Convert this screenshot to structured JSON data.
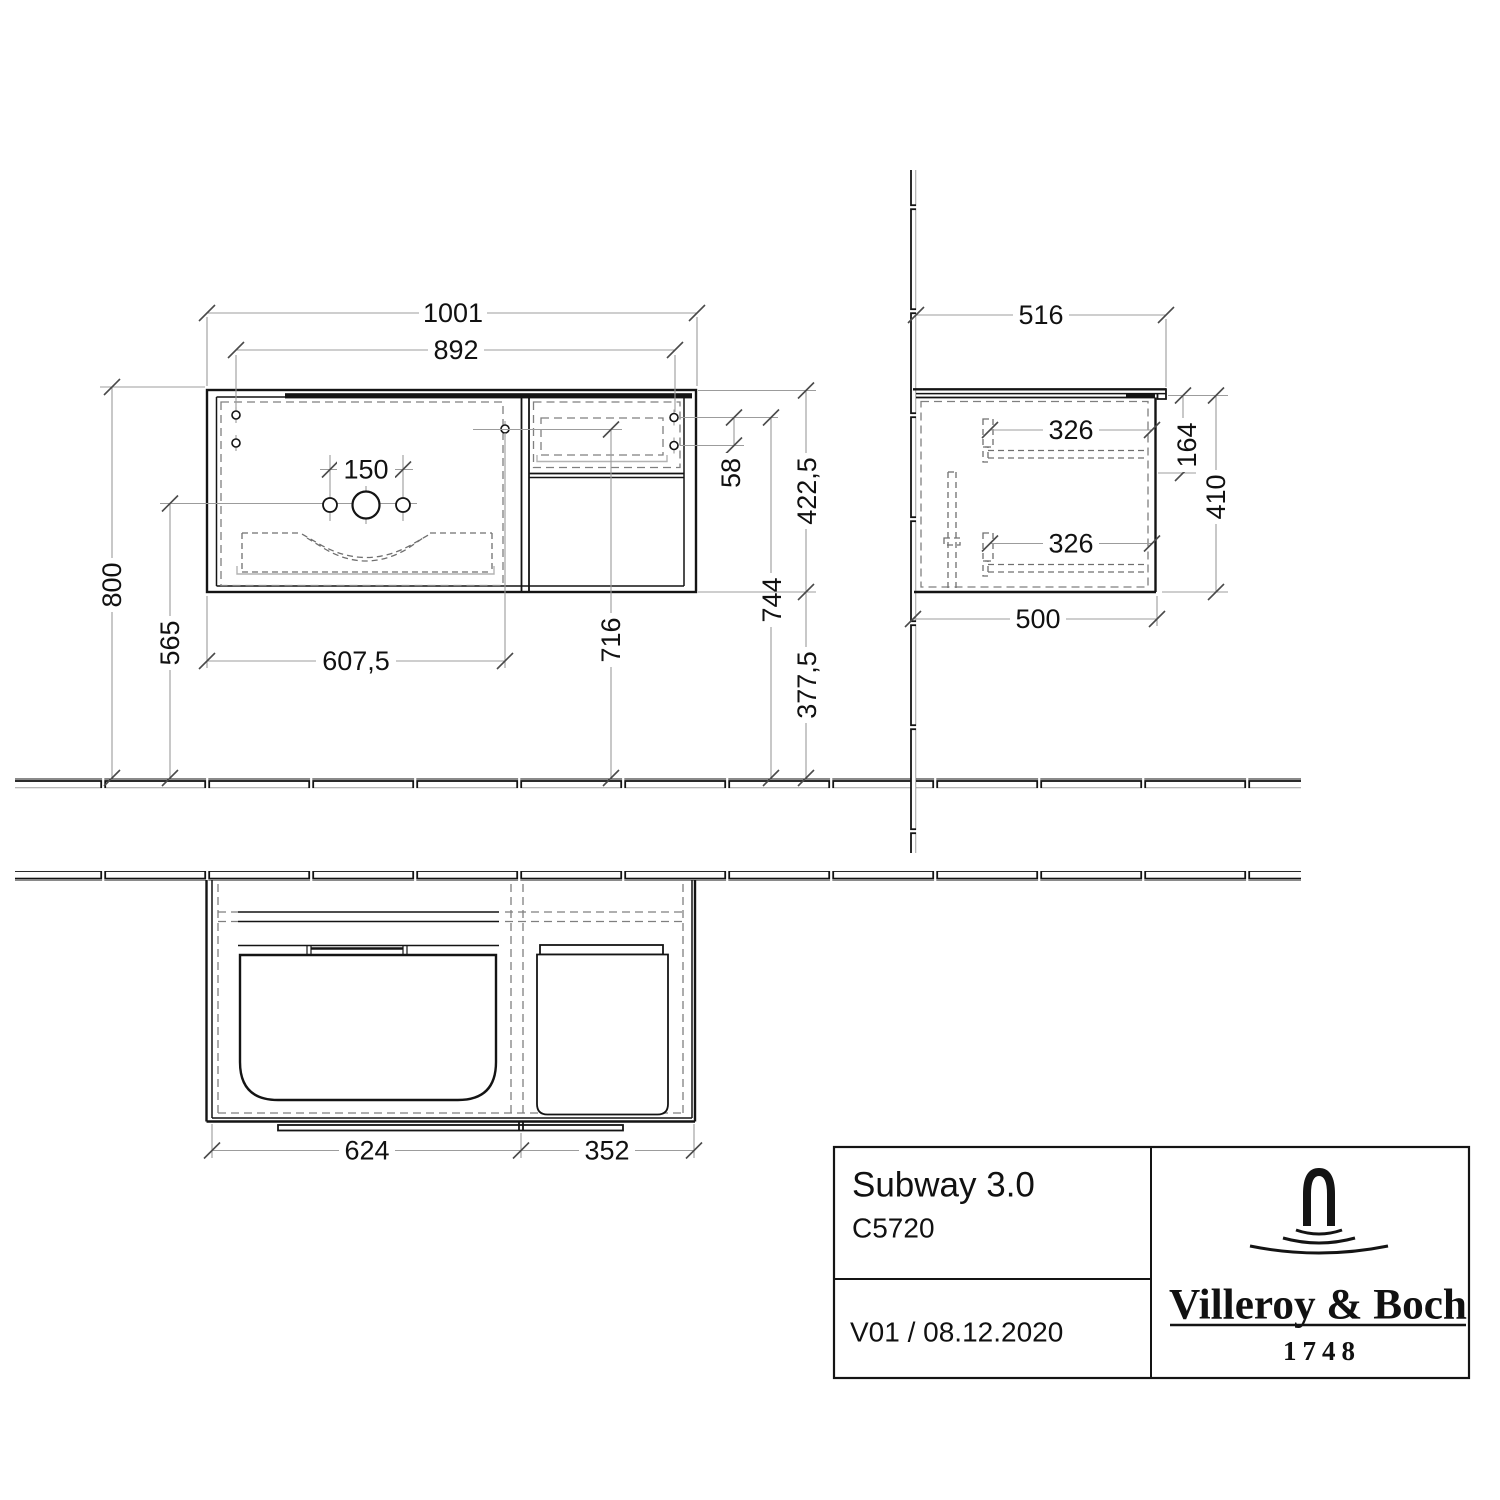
{
  "front_view": {
    "dims": {
      "total_width": "1001",
      "drilling_width": "892",
      "tap_hole_spacing": "150",
      "drain_center_offset": "607,5",
      "tap_center_height": "565",
      "top_edge_height": "800",
      "inner_drawer_height": "716",
      "mount_hole_spacing": "58",
      "mount_hole_height": "744",
      "cabinet_height": "422,5",
      "floor_clearance": "377,5"
    }
  },
  "side_view": {
    "dims": {
      "top_depth": "516",
      "upper_drawer_inner_depth": "326",
      "lower_drawer_inner_depth": "326",
      "upper_section_height": "164",
      "body_height": "410",
      "body_depth": "500"
    }
  },
  "bottom_view": {
    "dims": {
      "left_section_width": "624",
      "right_section_width": "352"
    }
  },
  "title_block": {
    "product_name": "Subway 3.0",
    "article_number": "C5720",
    "revision_date": "V01 / 08.12.2020",
    "brand_name": "Villeroy & Boch",
    "brand_year": "1748"
  },
  "colors": {
    "line": "#141414",
    "dashed": "#7f7f7f",
    "dimension": "#9c9c9c",
    "background": "#ffffff"
  }
}
